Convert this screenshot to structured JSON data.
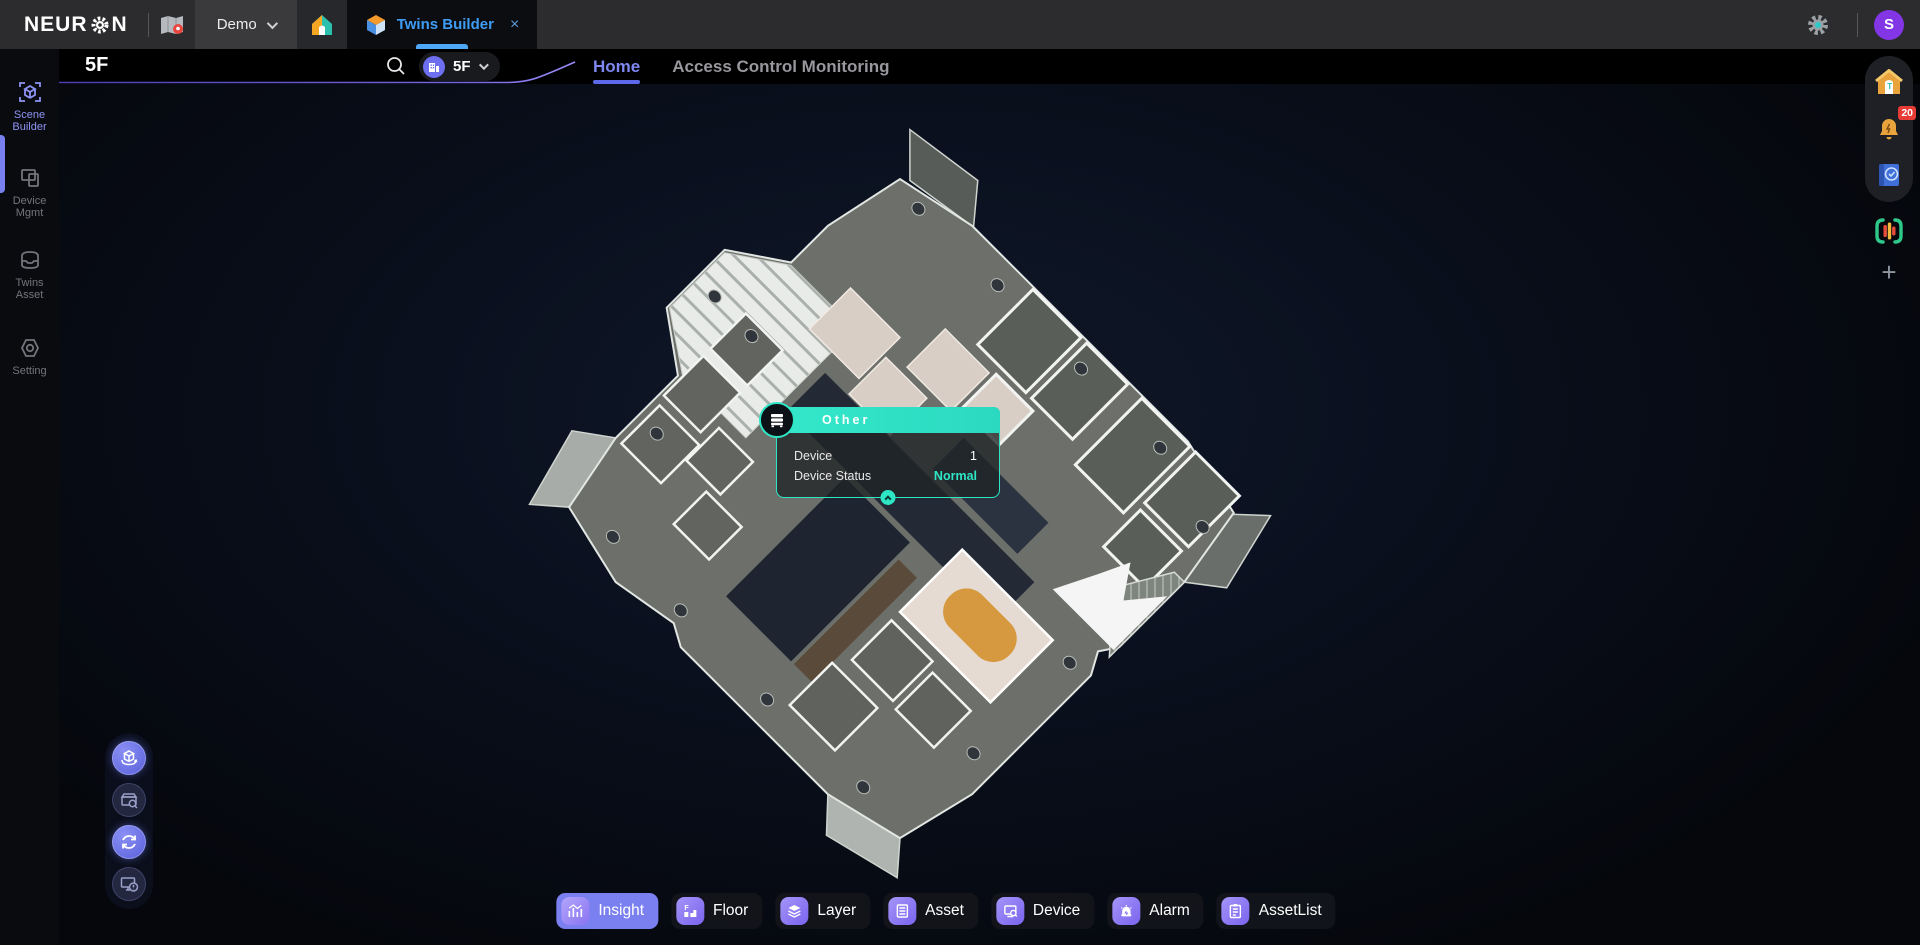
{
  "colors": {
    "accent_purple": "#7b80f0",
    "teal": "#2ee6c6",
    "tab_blue": "#3f9cf4",
    "badge_red": "#e73b35",
    "home_tab": "#7f88f2"
  },
  "app_bar": {
    "logo_left": "NEUR",
    "logo_right": "N",
    "project_tab": {
      "label": "Demo"
    },
    "active_tab": {
      "label": "Twins Builder",
      "close": "×"
    },
    "avatar": {
      "initial": "S"
    }
  },
  "sidebar": {
    "items": [
      {
        "label": "Scene Builder",
        "active": true
      },
      {
        "label": "Device Mgmt",
        "active": false
      },
      {
        "label": "Twins Asset",
        "active": false
      },
      {
        "label": "Setting",
        "active": false
      }
    ]
  },
  "scene_header": {
    "floor_title": "5F",
    "floor_selector": {
      "label": "5F"
    },
    "tabs": [
      {
        "label": "Home",
        "active": true
      },
      {
        "label": "Access Control Monitoring",
        "active": false
      }
    ]
  },
  "map_tooltip": {
    "title": "Other",
    "rows": [
      {
        "label": "Device",
        "value": "1"
      },
      {
        "label": "Device Status",
        "value": "Normal",
        "status_color": "#2ee6c6"
      }
    ]
  },
  "bottom_toolbar": {
    "buttons": [
      {
        "label": "Insight",
        "icon": "insight-chart-icon",
        "active": true
      },
      {
        "label": "Floor",
        "icon": "floor-stairs-icon",
        "active": false
      },
      {
        "label": "Layer",
        "icon": "layers-icon",
        "active": false
      },
      {
        "label": "Asset",
        "icon": "asset-cabinet-icon",
        "active": false
      },
      {
        "label": "Device",
        "icon": "device-search-icon",
        "active": false
      },
      {
        "label": "Alarm",
        "icon": "alarm-light-icon",
        "active": false
      },
      {
        "label": "AssetList",
        "icon": "asset-list-icon",
        "active": false
      }
    ]
  },
  "right_rail": {
    "notification_badge": "20",
    "add_label": "+"
  }
}
